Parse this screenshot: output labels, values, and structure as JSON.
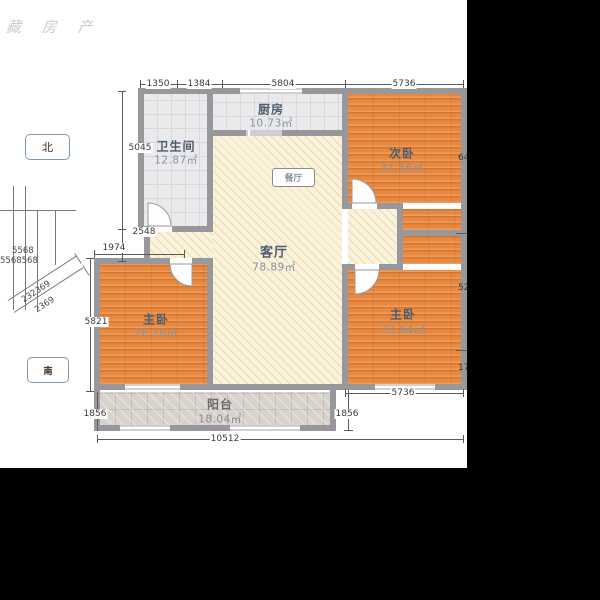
{
  "watermark": "藏 房 产",
  "compass": {
    "north": "北",
    "south": "南"
  },
  "rooms": {
    "kitchen": {
      "name": "厨房",
      "area": "10.73㎡"
    },
    "bathroom": {
      "name": "卫生间",
      "area": "12.87㎡"
    },
    "bedroom2": {
      "name": "次卧",
      "area": "31.56㎡"
    },
    "living": {
      "name": "客厅",
      "area": "78.89㎡"
    },
    "dining": {
      "name": "餐厅"
    },
    "master_left": {
      "name": "主卧",
      "area": "26.16㎡"
    },
    "master_right": {
      "name": "主卧",
      "area": "33.94㎡"
    },
    "balcony": {
      "name": "阳台",
      "area": "18.04㎡"
    }
  },
  "dimensions": {
    "top": [
      "1350",
      "1384",
      "5804",
      "5736"
    ],
    "left": {
      "d5045": "5045",
      "d2548": "2548",
      "d1974": "1974",
      "d5821": "5821"
    },
    "bottom": {
      "d5736": "5736",
      "d1856_left": "1856",
      "d1856_right": "1856",
      "d10512": "10512"
    },
    "right_truncated": {
      "r1": "64",
      "r2": "52",
      "r3": "17"
    },
    "stray": {
      "s1": "5568",
      "s2": "5568568",
      "s3": "232369",
      "s4": "2369"
    }
  },
  "colors": {
    "wood": "#e8893f",
    "living_floor": "#faf2da",
    "tile": "#eaeaec",
    "balcony_floor": "#d8d2cd",
    "wall": "#97979c",
    "compass_border": "#7d98ac",
    "room_label": "#4c5d6e",
    "area_label": "#8295a5",
    "dimension_text": "#3a3a3a",
    "letterbox": "#000000"
  }
}
